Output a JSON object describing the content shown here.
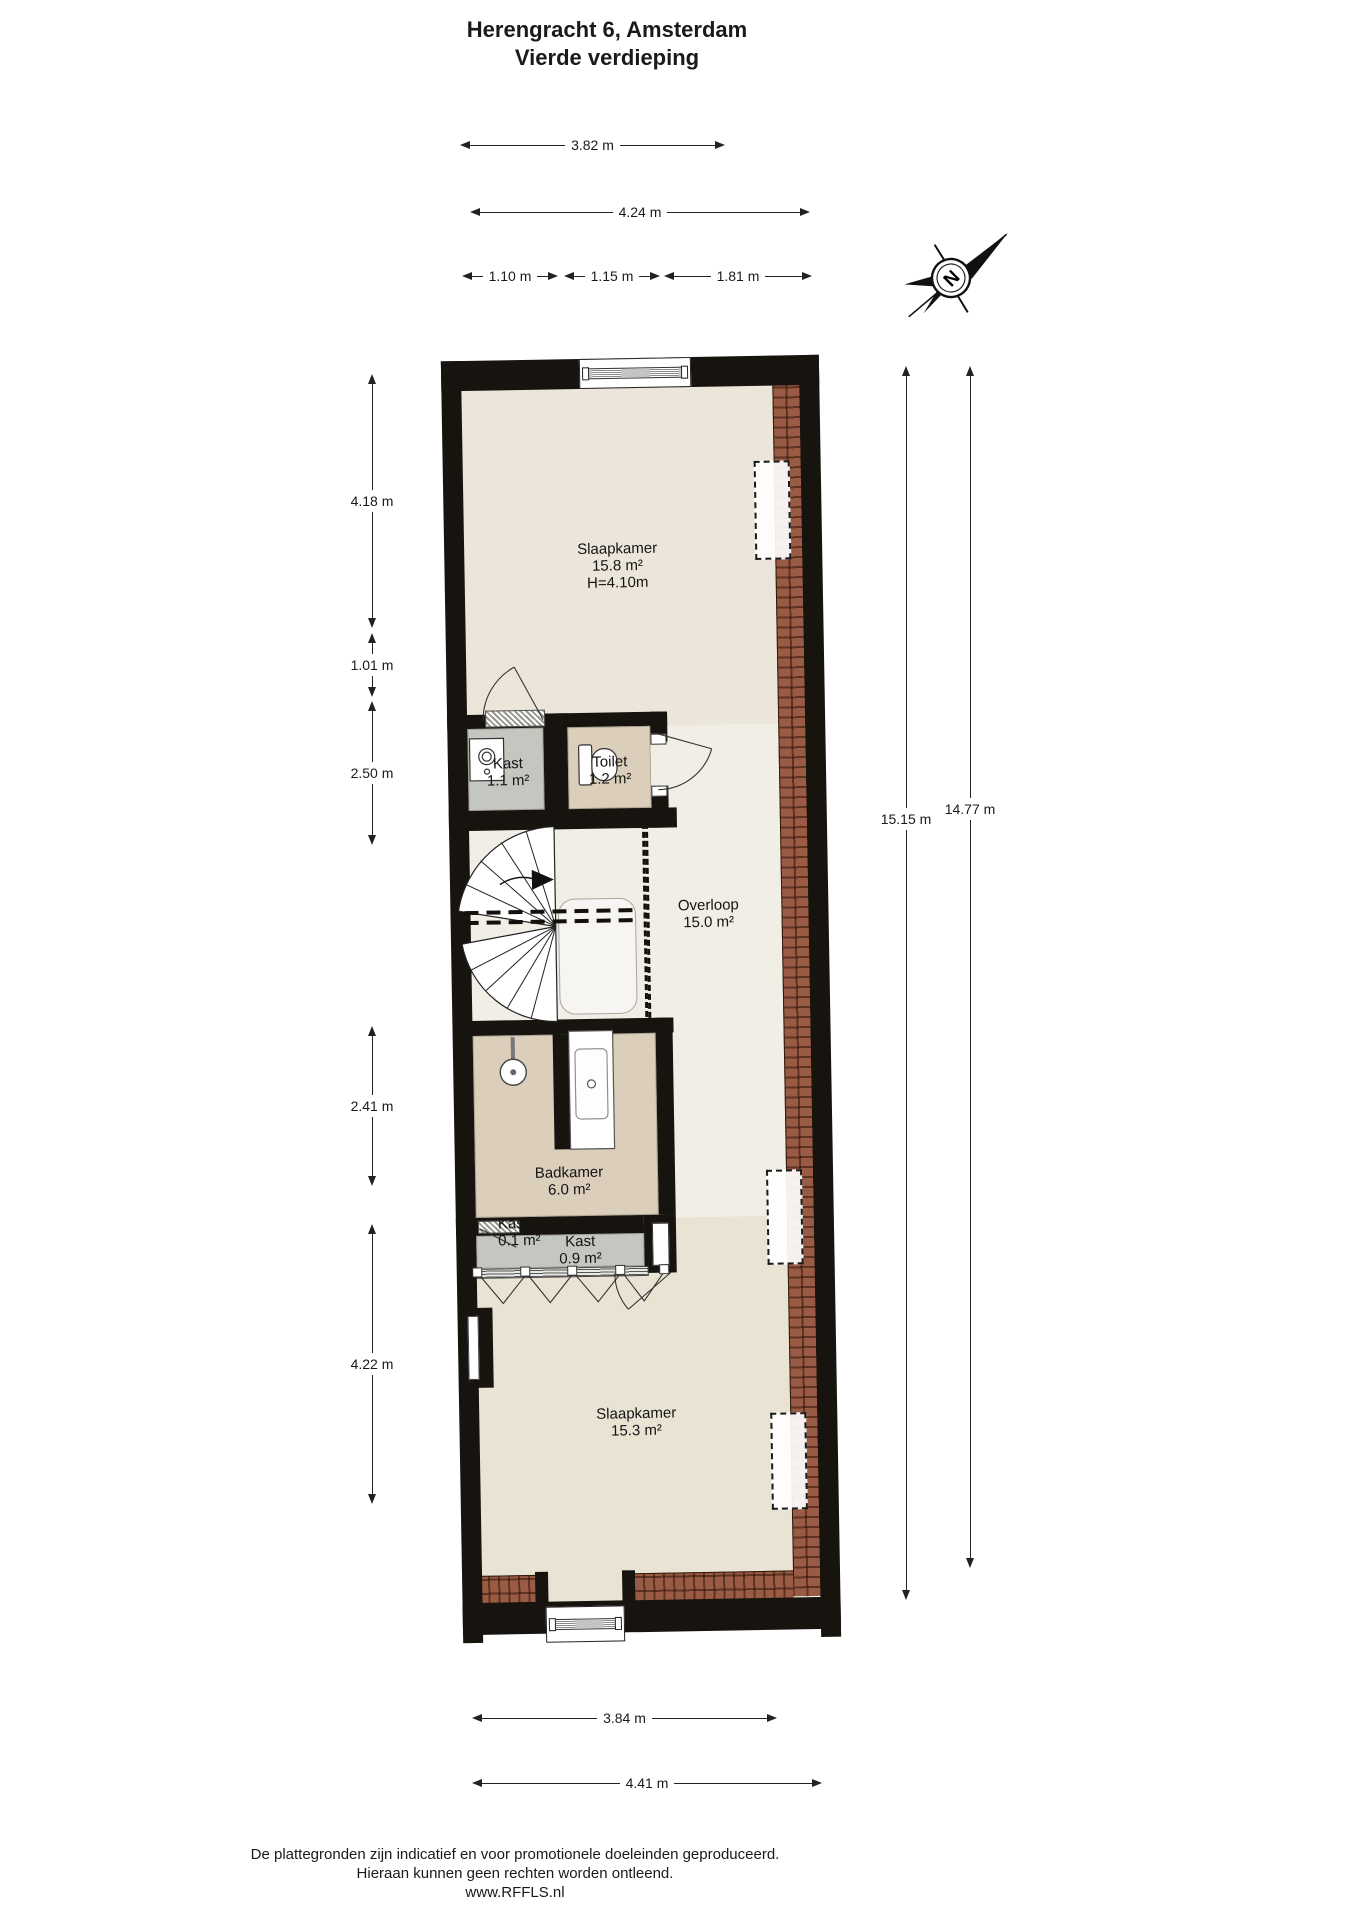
{
  "title": {
    "line1": "Herengracht 6, Amsterdam",
    "line2": "Vierde verdieping"
  },
  "compass": {
    "north_letter": "N"
  },
  "dimensions": {
    "top_width_inner": "3.82 m",
    "top_width_outer": "4.24 m",
    "top_segments": [
      "1.10 m",
      "1.15 m",
      "1.81 m"
    ],
    "left": [
      "4.18 m",
      "1.01 m",
      "2.50 m",
      "2.41 m",
      "4.22 m"
    ],
    "right": [
      "15.15 m",
      "14.77 m"
    ],
    "bottom": [
      "3.84 m",
      "4.41 m"
    ]
  },
  "rooms": {
    "slaapkamer_top": {
      "name": "Slaapkamer",
      "area": "15.8 m²",
      "height": "H=4.10m"
    },
    "kast_upper": {
      "name": "Kast",
      "area": "1.1 m²"
    },
    "toilet": {
      "name": "Toilet",
      "area": "1.2 m²"
    },
    "overloop": {
      "name": "Overloop",
      "area": "15.0 m²"
    },
    "badkamer": {
      "name": "Badkamer",
      "area": "6.0 m²"
    },
    "kast_small": {
      "name": "Kast",
      "area": "0.1 m²"
    },
    "kast_wide": {
      "name": "Kast",
      "area": "0.9 m²"
    },
    "slaapkamer_bottom": {
      "name": "Slaapkamer",
      "area": "15.3 m²"
    }
  },
  "footer": {
    "line1": "De plattegronden zijn indicatief en voor promotionele doeleinden geproduceerd.",
    "line2": "Hieraan kunnen geen rechten worden ontleend.",
    "line3": "www.RFFLS.nl"
  },
  "colors": {
    "wall": "#17130e",
    "floor_cream": "#ebe6d9",
    "floor_light": "#f1eee6",
    "floor_lower": "#e9e3d3",
    "room_tan": "#dbceba",
    "closet_gray": "#c4c7c0",
    "roof_tile": "#9a5b45",
    "roof_tile_dark": "#6e3c2a"
  }
}
